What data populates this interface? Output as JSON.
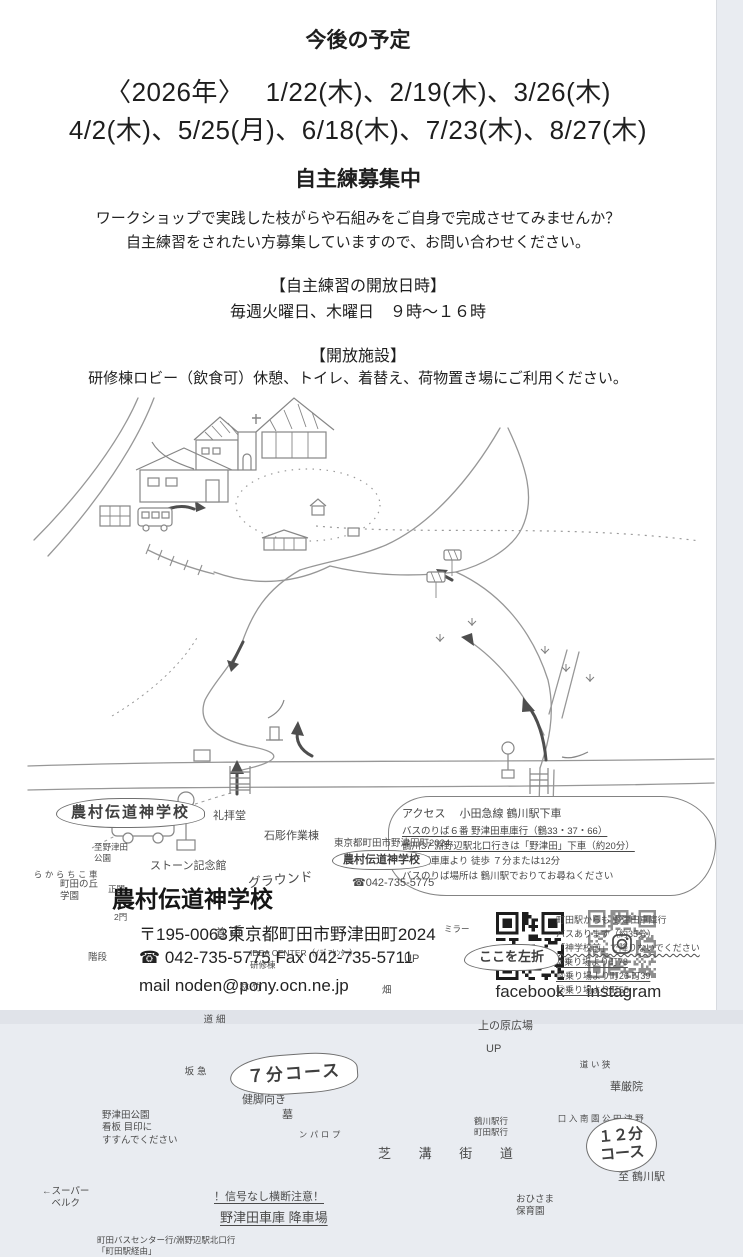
{
  "schedule": {
    "title": "今後の予定",
    "line1": "〈2026年〉　 1/22(木)、2/19(木)、3/26(木)",
    "line2": "4/2(木)、5/25(月)、6/18(木)、7/23(木)、8/27(木)"
  },
  "recruit": {
    "title": "自主練募集中",
    "desc1": "ワークショップで実践した枝がらや石組みをご自身で完成させてみませんか？",
    "desc2": "自主練習をされたい方募集していますので、お問い合わせください。",
    "hours_title": "【自主練習の開放日時】",
    "hours": "毎週火曜日、木曜日　９時～１６時",
    "facility_title": "【開放施設】",
    "facility": "研修棟ロビー（飲食可）休憩、トイレ、着替え、荷物置き場にご利用ください。"
  },
  "access": {
    "lines": [
      {
        "t": "アクセス　 小田急線 鶴川駅下車",
        "cls": "hd"
      },
      {
        "t": "バスのりば６番 野津田車庫行（鶴33・37・66）",
        "cls": "u"
      },
      {
        "t": "鶴川37 淵野辺駅北口行きは「野津田」下車（約20分）",
        "cls": "u"
      },
      {
        "t": "野津田車庫より 徒歩 ７分または12分",
        "cls": ""
      },
      {
        "t": "バスのりば場所は 鶴川駅でおりてお尋ねください",
        "cls": ""
      }
    ]
  },
  "machida_bus": {
    "lines": [
      {
        "t": "町田駅からも 野津田車庫行",
        "cls": ""
      },
      {
        "t": "バスあります（約35分）",
        "cls": ""
      },
      {
        "t": "「神学校前」で降りないでください",
        "cls": "uw"
      },
      {
        "t": "②乗り場より町78",
        "cls": "u"
      },
      {
        "t": "⑭乗り場より町26 町39",
        "cls": "u"
      },
      {
        "t": "⑫乗り場より町55",
        "cls": "u"
      }
    ]
  },
  "map": {
    "labels": [
      {
        "t": "農村伝道神学校",
        "x": 56,
        "y": 406,
        "cls": "bubbleMain"
      },
      {
        "t": "礼拝堂",
        "x": 213,
        "y": 417,
        "cls": "s"
      },
      {
        "t": "石彫作業棟",
        "x": 264,
        "y": 437,
        "cls": "s"
      },
      {
        "t": "ストーン記念館",
        "x": 150,
        "y": 467,
        "cls": "s"
      },
      {
        "t": "グラウンド",
        "x": 248,
        "y": 480,
        "cls": "m tilt"
      },
      {
        "t": "至野津田\n公園",
        "x": 94,
        "y": 450,
        "cls": "xxs"
      },
      {
        "t": "町田の丘\n学園",
        "x": 60,
        "y": 487,
        "cls": "xs"
      },
      {
        "t": "車こちらから",
        "x": 32,
        "y": 478,
        "cls": "xxs vert"
      },
      {
        "t": "正門",
        "x": 108,
        "y": 492,
        "cls": "xxs"
      },
      {
        "t": "2門",
        "x": 114,
        "y": 520,
        "cls": "xxs"
      },
      {
        "t": "階段",
        "x": 88,
        "y": 560,
        "cls": "xs"
      },
      {
        "t": "近道",
        "x": 209,
        "y": 534,
        "cls": "m vert tilt"
      },
      {
        "t": "IDEA CENTER（ｲﾃﾞｱｾﾝﾀｰ）",
        "x": 250,
        "y": 556,
        "cls": "xxs"
      },
      {
        "t": "研修棟",
        "x": 250,
        "y": 568,
        "cls": "xxs"
      },
      {
        "t": "竹林",
        "x": 236,
        "y": 590,
        "cls": "xs vert"
      },
      {
        "t": "畑",
        "x": 382,
        "y": 593,
        "cls": "xs"
      },
      {
        "t": "細道",
        "x": 200,
        "y": 622,
        "cls": "xs vert"
      },
      {
        "t": "急坂",
        "x": 181,
        "y": 674,
        "cls": "xs vert"
      },
      {
        "t": "７分コース",
        "x": 230,
        "y": 662,
        "cls": "bubble7"
      },
      {
        "t": "健脚向き",
        "x": 242,
        "y": 701,
        "cls": "s"
      },
      {
        "t": "墓",
        "x": 282,
        "y": 716,
        "cls": "s"
      },
      {
        "t": "野津田公園\n看板 目印に\nすすんでください",
        "x": 102,
        "y": 718,
        "cls": "xs"
      },
      {
        "t": "プロパン",
        "x": 297,
        "y": 738,
        "cls": "xxs vert"
      },
      {
        "t": "←スーパー\n　ベルク",
        "x": 42,
        "y": 794,
        "cls": "xs"
      },
      {
        "t": "！信号なし横断注意！",
        "x": 214,
        "y": 798,
        "cls": "s uline"
      },
      {
        "t": "野津田車庫 降車場",
        "x": 220,
        "y": 818,
        "cls": "m uline"
      },
      {
        "t": "町田バスセンター行/淵野辺駅北口行\n「町田駅経由」",
        "x": 97,
        "y": 843,
        "cls": "xxs"
      },
      {
        "t": "芝 溝 街 道",
        "x": 378,
        "y": 754,
        "cls": "m sp"
      },
      {
        "t": "至 鶴川駅",
        "x": 618,
        "y": 778,
        "cls": "s"
      },
      {
        "t": "おひさま\n保育園",
        "x": 516,
        "y": 802,
        "cls": "xs"
      },
      {
        "t": "１２分\nコース",
        "x": 586,
        "y": 726,
        "cls": "bubble12"
      },
      {
        "t": "華厳院",
        "x": 610,
        "y": 688,
        "cls": "s"
      },
      {
        "t": "上の原広場",
        "x": 478,
        "y": 627,
        "cls": "s"
      },
      {
        "t": "UP",
        "x": 404,
        "y": 560,
        "cls": "s"
      },
      {
        "t": "UP",
        "x": 486,
        "y": 650,
        "cls": "s"
      },
      {
        "t": "ここを左折",
        "x": 464,
        "y": 552,
        "cls": "cloud2"
      },
      {
        "t": "ミラー",
        "x": 444,
        "y": 532,
        "cls": "xxs"
      },
      {
        "t": "狭い道",
        "x": 578,
        "y": 668,
        "cls": "xxs vert"
      },
      {
        "t": "鶴川駅行\n町田駅行",
        "x": 474,
        "y": 724,
        "cls": "xxs"
      },
      {
        "t": "野津田公園\n南入口",
        "x": 556,
        "y": 722,
        "cls": "xxs vert"
      },
      {
        "t": "東京都町田市野津田町2024",
        "x": 334,
        "y": 446,
        "cls": "xs"
      },
      {
        "t": "農村伝道神学校",
        "x": 332,
        "y": 458,
        "cls": "bubble s"
      },
      {
        "t": "☎042-735-5775",
        "x": 352,
        "y": 484,
        "cls": "s"
      }
    ]
  },
  "footer": {
    "name": "農村伝道神学校",
    "address": "〒195-0063東京都町田市野津田町2024",
    "tel_fax": "☎ 042-735-5775 Fax 042-735-5711",
    "mail": "mail  noden@pony.ocn.ne.jp",
    "facebook_label": "facebook",
    "instagram_label": "instagram"
  }
}
